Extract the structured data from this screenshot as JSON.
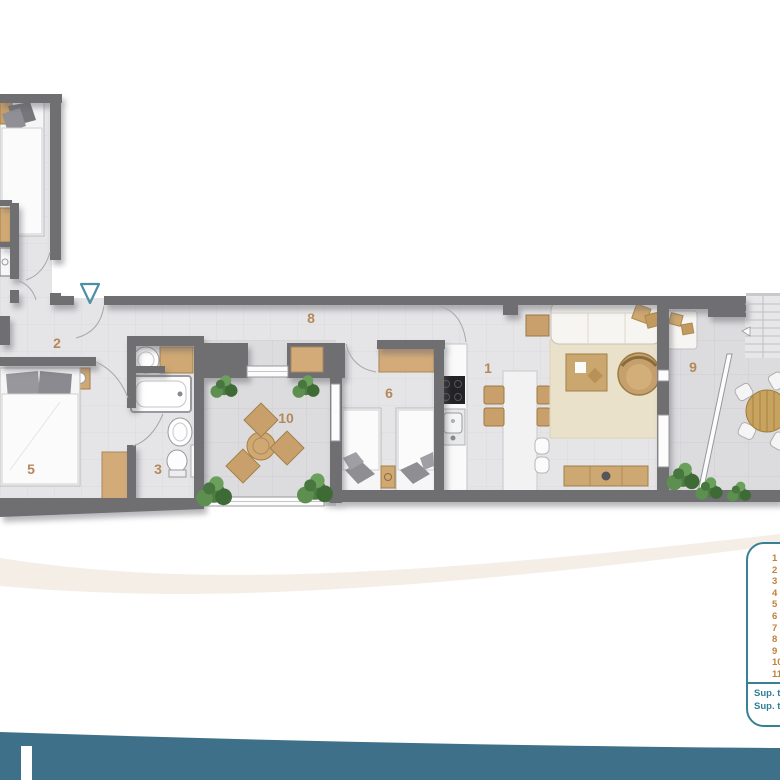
{
  "floorplan": {
    "labels": {
      "living_kitchen": "1",
      "hall": "2",
      "bathroom": "3",
      "bedroom_main": "5",
      "bedroom_twin": "6",
      "corridor": "8",
      "terrace_right": "9",
      "terrace_center": "10"
    },
    "label_color": "#b5885c",
    "wall_color": "#6f6e70",
    "entrance_arrow_color": "#4e8fa3"
  },
  "legend": {
    "numbers": [
      "1",
      "2",
      "3",
      "4",
      "5",
      "6",
      "7",
      "8",
      "9",
      "10",
      "11"
    ],
    "totals": [
      "Sup. to",
      "Sup. to"
    ],
    "number_color": "#c2803c",
    "border_color": "#3a8095",
    "text_color": "#2e7f93"
  },
  "footer": {
    "band_color": "#3e7089"
  }
}
